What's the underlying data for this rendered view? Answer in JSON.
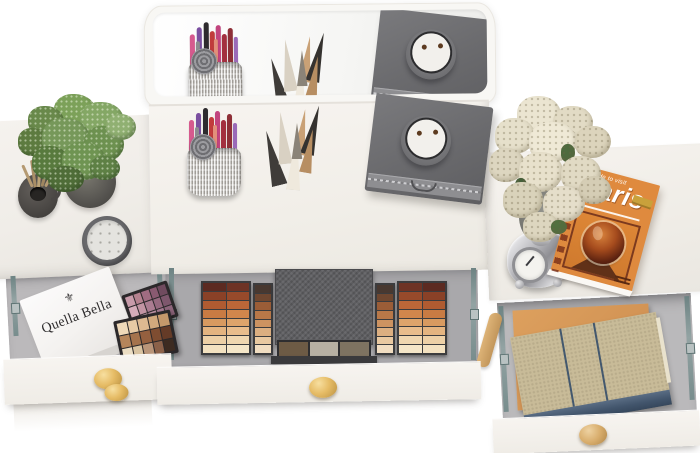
{
  "scene": {
    "name": "vanity-dressing-table-top-view",
    "background": "#ffffff"
  },
  "labels": {
    "gift_box_brand": "Quella Bella",
    "gift_box_crest": "⚜"
  },
  "paris_book": {
    "kicker": "Guide to visit",
    "title": "Paris",
    "cover_color": "#df8a3e",
    "badge_color": "#c9a13b"
  },
  "colors": {
    "table_surface": "#f4f1ec",
    "drawer_interior": "#b9b8ba",
    "gold_knob": "#e0b765",
    "wood_knob": "#d7ad6e",
    "palette_case": "#616164",
    "drawer_rail": "#7e9292"
  },
  "palettes": {
    "large_left_wing": {
      "cols": 2,
      "colors": [
        "#5c2a21",
        "#6e3325",
        "#8a4127",
        "#974a2b",
        "#b05b31",
        "#bc6738",
        "#c97b43",
        "#d1864c",
        "#d89a60",
        "#dea46b",
        "#e4b480",
        "#e9bd8c",
        "#edd0a6",
        "#f0d7b0",
        "#f3e1c0",
        "#f5e6c8"
      ]
    },
    "large_inner_left": {
      "cols": 1,
      "colors": [
        "#483830",
        "#6f4730",
        "#9b5d37",
        "#b97848",
        "#cd9361",
        "#dcaf81",
        "#e9c9a1",
        "#f1ddc1"
      ]
    },
    "large_inner_right": {
      "cols": 1,
      "colors": [
        "#483830",
        "#6f4730",
        "#9b5d37",
        "#b97848",
        "#cd9361",
        "#dcaf81",
        "#e9c9a1",
        "#f1ddc1"
      ]
    },
    "large_right_wing": {
      "cols": 2,
      "colors": [
        "#6e3325",
        "#5c2a21",
        "#974a2b",
        "#8a4127",
        "#bc6738",
        "#b05b31",
        "#d1864c",
        "#c97b43",
        "#dea46b",
        "#d89a60",
        "#e9bd8c",
        "#e4b480",
        "#f0d7b0",
        "#edd0a6",
        "#f5e6c8",
        "#f3e1c0"
      ]
    },
    "large_pans": {
      "cols": 3,
      "colors": [
        "#6d5b45",
        "#b7b0a2",
        "#7e7361"
      ]
    },
    "pink": {
      "cols": 5,
      "colors": [
        "#c89baa",
        "#b5818f",
        "#a06c81",
        "#8a5a71",
        "#704b5f",
        "#d5acb9",
        "#c294a3",
        "#ab7c91",
        "#96697f",
        "#7e576d",
        "#e1bfca",
        "#d0a9b7",
        "#ba90a3",
        "#a3798f",
        "#8d657b"
      ]
    },
    "nude": {
      "cols": 5,
      "colors": [
        "#efd9b9",
        "#e7caa5",
        "#ddb991",
        "#d1a97d",
        "#c5996b",
        "#b5855b",
        "#a5734d",
        "#95603f",
        "#7f4d31",
        "#653b27",
        "#ebddc3",
        "#d9c3a1",
        "#b99579",
        "#8b6149",
        "#3d2b21"
      ]
    }
  },
  "shapes": {
    "plant_foliage": [
      {
        "n": "leaf-clump",
        "x": 36,
        "y": 2,
        "w": 42,
        "h": 34,
        "bg": "#7ca159"
      },
      {
        "n": "leaf-clump",
        "x": 10,
        "y": 14,
        "w": 36,
        "h": 30,
        "bg": "#69894b"
      },
      {
        "n": "leaf-clump",
        "x": 62,
        "y": 10,
        "w": 44,
        "h": 36,
        "bg": "#84a765"
      },
      {
        "n": "leaf-clump",
        "x": 0,
        "y": 36,
        "w": 30,
        "h": 28,
        "bg": "#5d7b40"
      },
      {
        "n": "leaf-clump",
        "x": 24,
        "y": 26,
        "w": 48,
        "h": 42,
        "bg": "#76985a"
      },
      {
        "n": "leaf-clump",
        "x": 66,
        "y": 34,
        "w": 40,
        "h": 36,
        "bg": "#6d9150"
      },
      {
        "n": "leaf-clump",
        "x": 88,
        "y": 22,
        "w": 30,
        "h": 26,
        "bg": "#90b072"
      },
      {
        "n": "leaf-clump",
        "x": 14,
        "y": 54,
        "w": 38,
        "h": 34,
        "bg": "#587a3e"
      },
      {
        "n": "leaf-clump",
        "x": 44,
        "y": 50,
        "w": 44,
        "h": 38,
        "bg": "#6f9452"
      },
      {
        "n": "leaf-clump",
        "x": 30,
        "y": 74,
        "w": 36,
        "h": 26,
        "bg": "#4f6d38"
      },
      {
        "n": "leaf-clump",
        "x": 72,
        "y": 64,
        "w": 30,
        "h": 24,
        "bg": "#5e8045"
      }
    ],
    "flower_blobs": [
      {
        "n": "flower-cluster",
        "x": 28,
        "y": 0,
        "w": 44,
        "h": 38,
        "bg": "#ebe5d1"
      },
      {
        "n": "flower-cluster",
        "x": 64,
        "y": 10,
        "w": 40,
        "h": 34,
        "bg": "#e2dbc5"
      },
      {
        "n": "flower-cluster",
        "x": 6,
        "y": 22,
        "w": 40,
        "h": 36,
        "bg": "#e6e0cb"
      },
      {
        "n": "flower-cluster",
        "x": 40,
        "y": 26,
        "w": 48,
        "h": 40,
        "bg": "#efe9d6"
      },
      {
        "n": "flower-cluster",
        "x": 86,
        "y": 30,
        "w": 36,
        "h": 32,
        "bg": "#dcd4bc"
      },
      {
        "n": "flower-cluster",
        "x": 0,
        "y": 52,
        "w": 36,
        "h": 34,
        "bg": "#ddd6c0"
      },
      {
        "n": "leaf",
        "x": 72,
        "y": 48,
        "w": 14,
        "h": 18,
        "bg": "#4e6b3f"
      },
      {
        "n": "flower-cluster",
        "x": 30,
        "y": 56,
        "w": 44,
        "h": 40,
        "bg": "#e8e1cc"
      },
      {
        "n": "flower-cluster",
        "x": 72,
        "y": 60,
        "w": 40,
        "h": 36,
        "bg": "#e1dac4"
      },
      {
        "n": "leaf",
        "x": 26,
        "y": 82,
        "w": 12,
        "h": 16,
        "bg": "#45603a"
      },
      {
        "n": "flower-cluster",
        "x": 14,
        "y": 86,
        "w": 40,
        "h": 36,
        "bg": "#d9d2ba"
      },
      {
        "n": "flower-cluster",
        "x": 54,
        "y": 90,
        "w": 42,
        "h": 36,
        "bg": "#e5deca"
      },
      {
        "n": "flower-cluster",
        "x": 90,
        "y": 80,
        "w": 32,
        "h": 28,
        "bg": "#d5cdb5"
      },
      {
        "n": "flower-cluster",
        "x": 34,
        "y": 116,
        "w": 36,
        "h": 30,
        "bg": "#ddd6bf"
      },
      {
        "n": "leaf",
        "x": 62,
        "y": 124,
        "w": 16,
        "h": 14,
        "bg": "#52703f"
      }
    ],
    "diffuser_reeds": [
      {
        "n": "reed",
        "x": 0,
        "y": 6,
        "w": 3,
        "h": 24,
        "bg": "#b59a72",
        "tf": "rotate(-24deg)",
        "br": "2px"
      },
      {
        "n": "reed",
        "x": 6,
        "y": 2,
        "w": 3,
        "h": 28,
        "bg": "#a98e66",
        "tf": "rotate(-8deg)",
        "br": "2px"
      },
      {
        "n": "reed",
        "x": 12,
        "y": 0,
        "w": 3,
        "h": 30,
        "bg": "#bba377",
        "tf": "rotate(4deg)",
        "br": "2px"
      },
      {
        "n": "reed",
        "x": 18,
        "y": 3,
        "w": 3,
        "h": 26,
        "bg": "#9f8660",
        "tf": "rotate(16deg)",
        "br": "2px"
      },
      {
        "n": "reed",
        "x": 23,
        "y": 8,
        "w": 3,
        "h": 22,
        "bg": "#b59a72",
        "tf": "rotate(28deg)",
        "br": "2px"
      }
    ],
    "brush_sticks": [
      {
        "n": "makeup-pencil",
        "x": 5,
        "y": 12,
        "w": 5,
        "h": 36,
        "bg": "#d65a8e"
      },
      {
        "n": "makeup-pencil",
        "x": 12,
        "y": 5,
        "w": 5,
        "h": 42,
        "bg": "#7b4fa0"
      },
      {
        "n": "makeup-pencil",
        "x": 19,
        "y": 0,
        "w": 5,
        "h": 48,
        "bg": "#2e2b2e"
      },
      {
        "n": "makeup-pencil",
        "x": 25,
        "y": 9,
        "w": 5,
        "h": 40,
        "bg": "#c13b3b"
      },
      {
        "n": "makeup-pencil",
        "x": 31,
        "y": 3,
        "w": 5,
        "h": 45,
        "bg": "#c2447e"
      },
      {
        "n": "makeup-pencil",
        "x": 37,
        "y": 12,
        "w": 5,
        "h": 37,
        "bg": "#a3303f"
      },
      {
        "n": "makeup-pencil",
        "x": 43,
        "y": 6,
        "w": 5,
        "h": 41,
        "bg": "#8e2f37"
      },
      {
        "n": "makeup-pencil",
        "x": 49,
        "y": 15,
        "w": 4,
        "h": 33,
        "bg": "#9a6ab8"
      },
      {
        "n": "makeup-pencil",
        "x": 29,
        "y": 17,
        "w": 4,
        "h": 32,
        "bg": "#e2907a"
      },
      {
        "n": "makeup-pencil",
        "x": 11,
        "y": 19,
        "w": 4,
        "h": 29,
        "bg": "#8c8c90"
      }
    ],
    "tube_cones": [
      {
        "n": "cosmetic-tube",
        "x": 2,
        "y": 26,
        "w": 18,
        "h": 56,
        "bg": "#3f3c39",
        "cp": "polygon(50% 0, 94% 100%, 6% 100%)",
        "tf": "rotate(-14deg)"
      },
      {
        "n": "cosmetic-tube",
        "x": 13,
        "y": 8,
        "w": 16,
        "h": 52,
        "bg": "#d9d1c3",
        "cp": "polygon(50% 0, 94% 100%, 6% 100%)",
        "tf": "rotate(-6deg)"
      },
      {
        "n": "cosmetic-tube",
        "x": 25,
        "y": 28,
        "w": 16,
        "h": 58,
        "bg": "#efe9dd",
        "cp": "polygon(50% 0, 94% 100%, 6% 100%)",
        "tf": "rotate(4deg)"
      },
      {
        "n": "cosmetic-tube",
        "x": 33,
        "y": 5,
        "w": 14,
        "h": 46,
        "bg": "#c9a176",
        "cp": "polygon(50% 0, 94% 100%, 6% 100%)",
        "tf": "rotate(8deg)"
      },
      {
        "n": "cosmetic-tube",
        "x": 43,
        "y": 1,
        "w": 16,
        "h": 50,
        "bg": "#35322f",
        "cp": "polygon(50% 0, 94% 100%, 6% 100%)",
        "tf": "rotate(14deg)"
      },
      {
        "n": "cosmetic-tube",
        "x": 40,
        "y": 25,
        "w": 14,
        "h": 44,
        "bg": "#b78e62",
        "cp": "polygon(50% 0, 94% 100%, 6% 100%)",
        "tf": "rotate(10deg)"
      },
      {
        "n": "cosmetic-tube",
        "x": 29,
        "y": 19,
        "w": 12,
        "h": 36,
        "bg": "#8a8378",
        "cp": "polygon(50% 0, 94% 100%, 6% 100%)",
        "tf": "rotate(0deg)"
      }
    ]
  }
}
